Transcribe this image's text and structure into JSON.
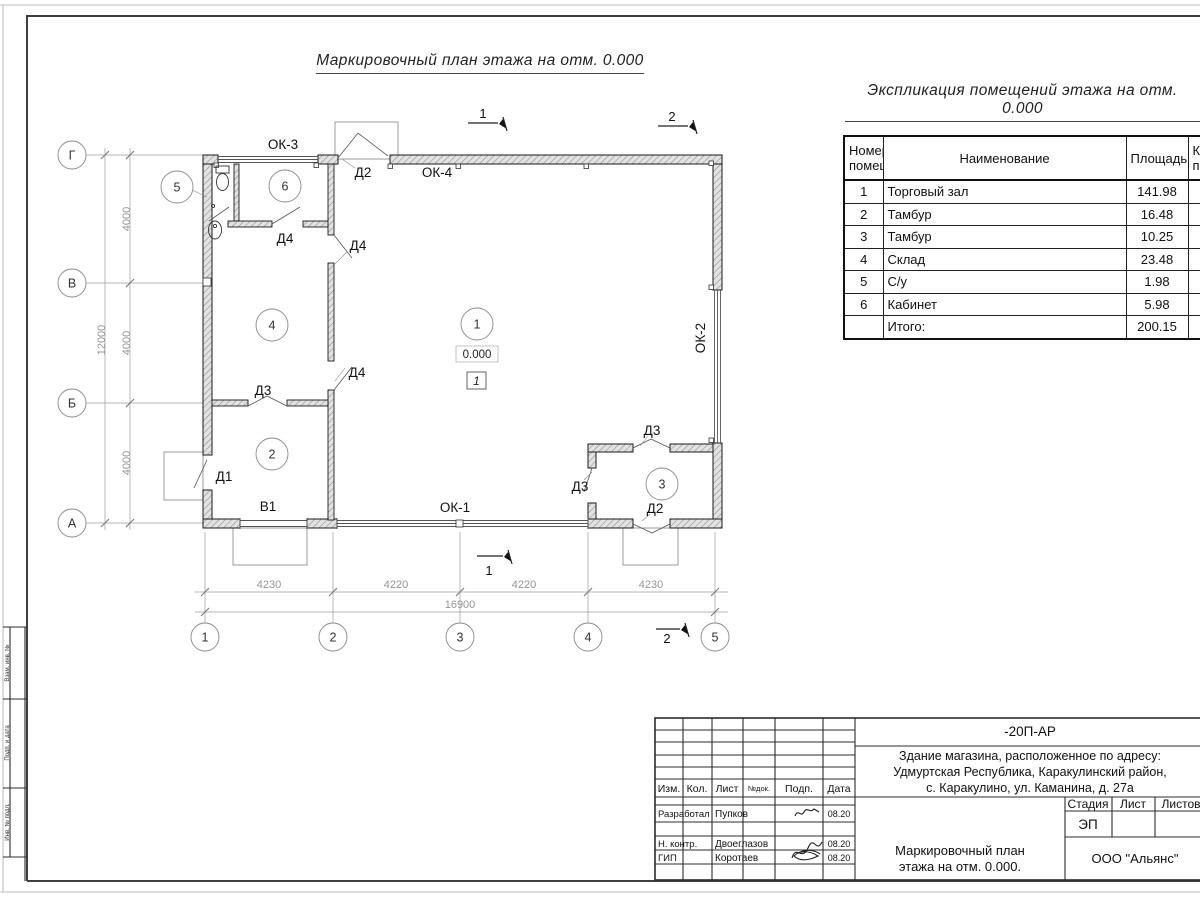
{
  "titles": {
    "plan": "Маркировочный план этажа на отм. 0.000",
    "explication": "Экспликация помещений этажа на отм. 0.000"
  },
  "plan": {
    "row_axes": [
      "Г",
      "В",
      "Б",
      "А"
    ],
    "col_axes": [
      "1",
      "2",
      "3",
      "4",
      "5"
    ],
    "v_dims": [
      "4000",
      "4000",
      "4000"
    ],
    "v_total": "12000",
    "h_dims": [
      "4230",
      "4220",
      "4220",
      "4230"
    ],
    "h_total": "16900",
    "rooms": [
      "1",
      "2",
      "3",
      "4",
      "5",
      "6"
    ],
    "doors": {
      "d1": "Д1",
      "d2": "Д2",
      "d3": "Д3",
      "d4": "Д4"
    },
    "windows": {
      "ok1": "ОК-1",
      "ok2": "ОК-2",
      "ok3": "ОК-3",
      "ok4": "ОК-4"
    },
    "gate": "В1",
    "elevation": "0.000",
    "floor_type": "1",
    "sections": {
      "s1": "1",
      "s2": "2"
    }
  },
  "explication": {
    "col_num_1": "Номер",
    "col_num_2": "помещ.",
    "col_name": "Наименование",
    "col_area": "Площадь",
    "col_cat_1": "Ка",
    "col_cat_2": "по",
    "rows": [
      {
        "num": "1",
        "name": "Торговый зал",
        "area": "141.98"
      },
      {
        "num": "2",
        "name": "Тамбур",
        "area": "16.48"
      },
      {
        "num": "3",
        "name": "Тамбур",
        "area": "10.25"
      },
      {
        "num": "4",
        "name": "Склад",
        "area": "23.48"
      },
      {
        "num": "5",
        "name": "С/у",
        "area": "1.98"
      },
      {
        "num": "6",
        "name": "Кабинет",
        "area": "5.98"
      },
      {
        "num": "",
        "name": "Итого:",
        "area": "200.15"
      }
    ]
  },
  "stamp": {
    "doc_code": "-20П-АР",
    "address1": "Здание магазина, расположенное по адресу:",
    "address2": "Удмуртская Республика, Каракулинский район,",
    "address3": "с. Каракулино, ул. Каманина, д. 27а",
    "cols": {
      "izm": "Изм.",
      "kol": "Кол.",
      "list": "Лист",
      "ndok": "№док.",
      "podp": "Подп.",
      "data": "Дата"
    },
    "rows": [
      {
        "role": "Разработал",
        "name": "Пупков",
        "date": "08.20"
      },
      {
        "role": "Н. контр.",
        "name": "Двоеглазов",
        "date": "08.20"
      },
      {
        "role": "ГИП",
        "name": "Коротаев",
        "date": "08.20"
      }
    ],
    "stage_label": "Стадия",
    "list_label": "Лист",
    "listov_label": "Листов",
    "stage": "ЭП",
    "name1": "Маркировочный план",
    "name2": "этажа на отм. 0.000.",
    "company": "ООО \"Альянс\""
  },
  "side_block": {
    "cells": [
      "Взам. инв. №",
      "Подп. и дата",
      "Инв. № подл."
    ]
  }
}
